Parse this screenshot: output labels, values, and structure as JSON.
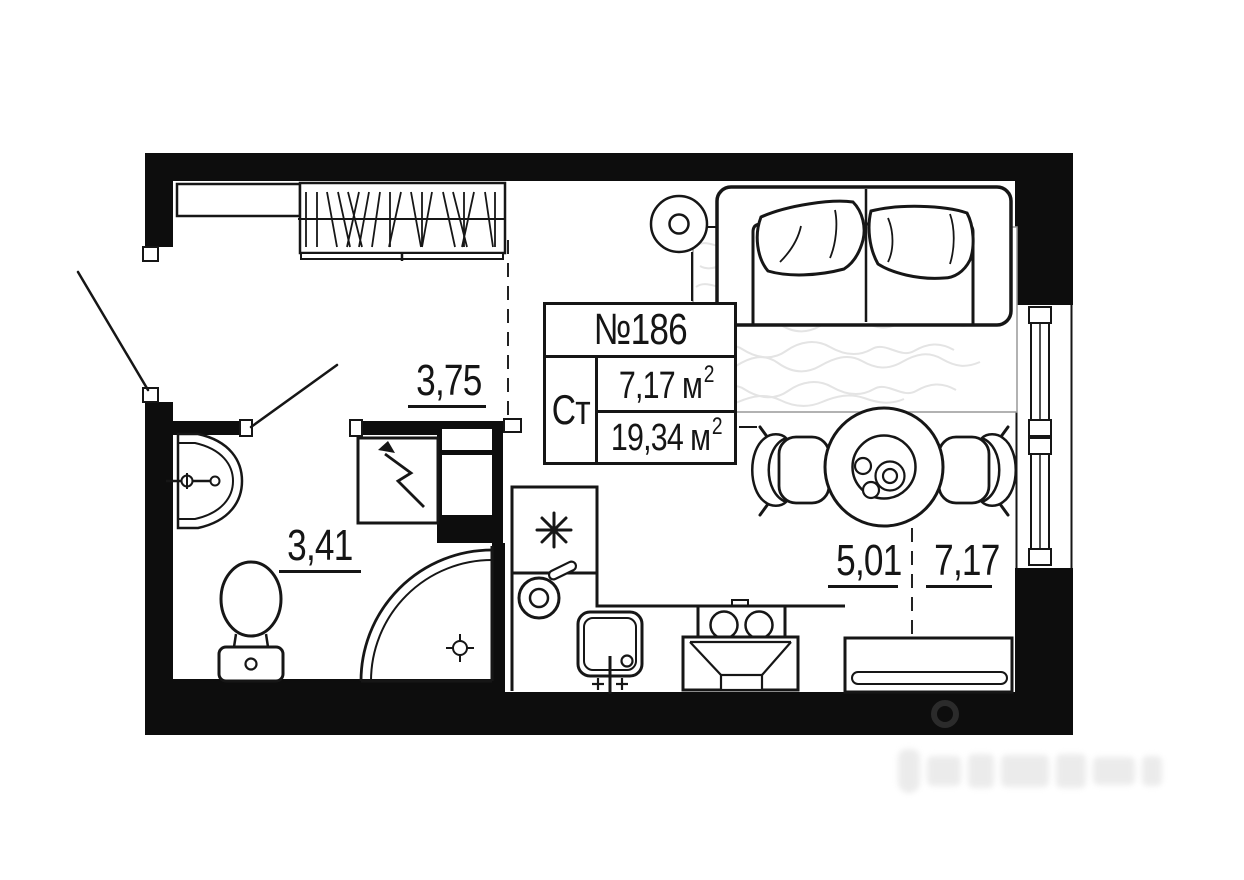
{
  "plan": {
    "unit_number": "№186",
    "unit_type": "Ст",
    "areas": {
      "living": {
        "value": "7,17",
        "unit": "м",
        "sup": "2"
      },
      "total": {
        "value": "19,34",
        "unit": "м",
        "sup": "2"
      }
    },
    "dimensions": {
      "hallway": "3,75",
      "bathroom": "3,41",
      "kitchen": "5,01",
      "living_room": "7,17"
    },
    "icons": {
      "fridge": "snowflake-asterisk-icon",
      "water_heater": "lightning-arrow-icon",
      "ceiling_lamp": "double-circle-lamp-icon",
      "shower_drain": "crosshair-drain-icon",
      "watermark": "ring-pin-logo-icon"
    },
    "colors": {
      "wall": "#0d0d0d",
      "line": "#161616",
      "rug_texture": "#e4e4e4",
      "background": "#ffffff"
    }
  }
}
